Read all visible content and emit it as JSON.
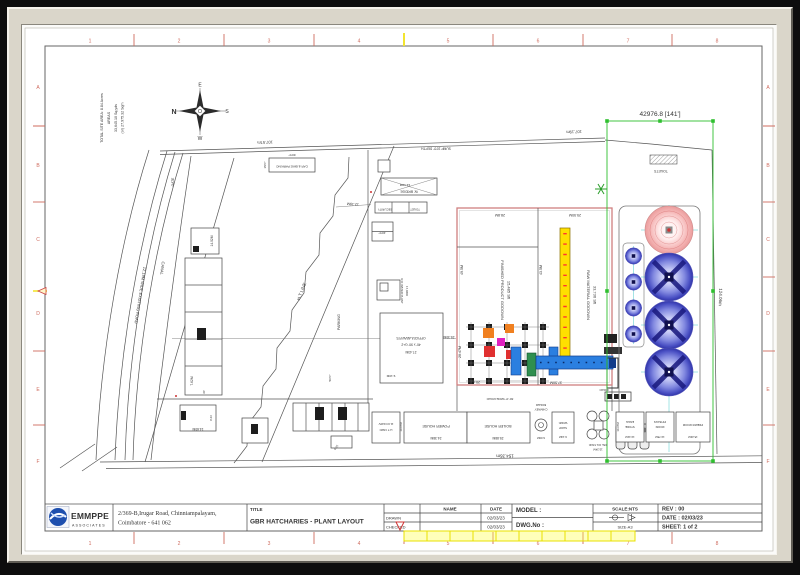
{
  "rulers": {
    "top": [
      "1",
      "2",
      "3",
      "4",
      "5",
      "6",
      "7",
      "8"
    ],
    "bottom": [
      "1",
      "2",
      "3",
      "4",
      "5",
      "6",
      "7",
      "8"
    ],
    "left": [
      "A",
      "B",
      "C",
      "D",
      "E",
      "F"
    ],
    "right": [
      "A",
      "B",
      "C",
      "D",
      "E",
      "F"
    ]
  },
  "compass": {
    "n": "N",
    "e": "E",
    "s": "S",
    "w": "W"
  },
  "site_info": {
    "areas_lines": [
      "TOTAL SITE AREA: 8.84 Acres",
      "AREAS",
      "33,645.10 Sq.yds",
      "(or) 27,975.32 Sqm"
    ]
  },
  "labels": {
    "canal": "CANAL",
    "existing_road": "12.19M WIDE EXISTING ROAD",
    "ht_line": "H.T LINE",
    "gate": "GATE",
    "parking": "PARKING",
    "car_bike_parking": "CAR & BIKE PARKING",
    "sump": "SUMP 10'0\" DEPTH",
    "w_bridge": "W. BRIDGE",
    "security": "SECURITY",
    "toilet": "TOILET",
    "toilets": "TOILETS",
    "ro_plant": "R.O WATER PLANT",
    "ro_plant2": "17,080lt",
    "office1": "OFFICE/LAB/W.R'S",
    "office2": "40' x 90' G+2",
    "fin_godown1": "FINISHED PRODUCT GODOWN",
    "fin_godown2": "15,485 Sft",
    "raw_godown1": "RAW MATERIAL GODOWN",
    "raw_godown2": "33,736 Sft",
    "power_house": "POWER HOUSE",
    "boiler_house": "BOILER HOUSE",
    "boiler_chimney1": "BOILER",
    "boiler_chimney2": "CHIMNEY",
    "work_shop1": "WORK",
    "work_shop2": "SHOP",
    "dsl_tank": "DSL OIL TANK",
    "engg_store1": "ENGG",
    "engg_store2": "STORE",
    "pp_bags1": "PP BAGS",
    "pp_bags2": "ROOM",
    "premix": "PREMIX ROOM",
    "ht_yard1": "11 KV/440V",
    "ht_yard2": "H.T YARD",
    "road": "ROAD",
    "wide_road": "30'-0\" WIDE ROAD"
  },
  "dims": {
    "d42976": "42976.8 [141']",
    "d10757": "107.57m",
    "d10719": "107.19m",
    "d15435": "154.35m",
    "d12406": "124.06m",
    "d1219": "12.19M",
    "d1219b": "12.19M",
    "d2743": "27.43M",
    "d2530": "25.30M",
    "d288": "28.8M",
    "d2550": "25.50M",
    "d495": "49.5M",
    "d435": "43.5M",
    "d2047": "20.47M",
    "d2047b": "20.47M",
    "d3750": "37.50M",
    "d2438": "24.38M",
    "d2588": "25.88M",
    "d600": "6.00M",
    "d914": "9.14M",
    "d1341": "13.41M",
    "d1378": "13.78M",
    "d1524": "15.24M",
    "d1524b": "15.24M",
    "d1067": "10.67M",
    "d1067b": "10.67M",
    "d1402": "14.02M",
    "d762": "7.62M",
    "d1460": "14.60M",
    "d823": "8.23",
    "d30": "30'",
    "d625": "6.25",
    "d910": "9.10M",
    "d600ft": "60'0\"",
    "d150ft": "15'0\"",
    "d400ft": "40'0\"",
    "d500ft": "50'0\""
  },
  "title_block": {
    "company": "EMMPPE",
    "company_sub": "ASSOCIATES",
    "address_line1": "2/369-B,Irugar Road, Chinniampalayam,",
    "address_line2": "Coimbatore - 641 062",
    "title_label": "TITLE",
    "title": "GBR HATCHARIES - PLANT LAYOUT",
    "col_name": "NAME",
    "col_date": "DATE",
    "row_drawn": "DRAWN",
    "row_checked": "CHECKED",
    "drawn_date": "02/03/23",
    "checked_date": "02/03/23",
    "model_label": "MODEL  :",
    "dwg_label": "DWG.No :",
    "scale": "SCALE:NTS",
    "size": "SIZE-A3",
    "rev": "REV : 00",
    "date": "DATE  : 02/03/23",
    "sheet": "SHEET: 1 of 2"
  }
}
